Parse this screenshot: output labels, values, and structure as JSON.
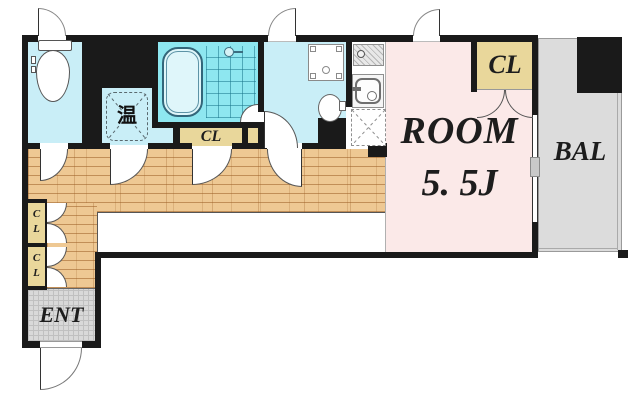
{
  "plan": {
    "water_heater": {
      "label": "温"
    },
    "bath_closet": {
      "label": "CL"
    },
    "room": {
      "name": "ROOM",
      "size": "5. 5J"
    },
    "room_closet": {
      "label": "CL"
    },
    "balcony": {
      "label": "BAL"
    },
    "entrance": {
      "label": "ENT"
    },
    "hall_closets": [
      {
        "letters": [
          "C",
          "L"
        ]
      },
      {
        "letters": [
          "C",
          "L"
        ]
      }
    ],
    "colors": {
      "wall": "#1a1a1a",
      "water_area": "#c9eef7",
      "bath": "#8ee7f0",
      "closet_fill": "#e9d79b",
      "room_fill": "#fbe9e8",
      "balcony_fill": "#dcdcdc",
      "entrance_fill": "#d9d9d9",
      "wood_floor": "#eec893"
    }
  }
}
